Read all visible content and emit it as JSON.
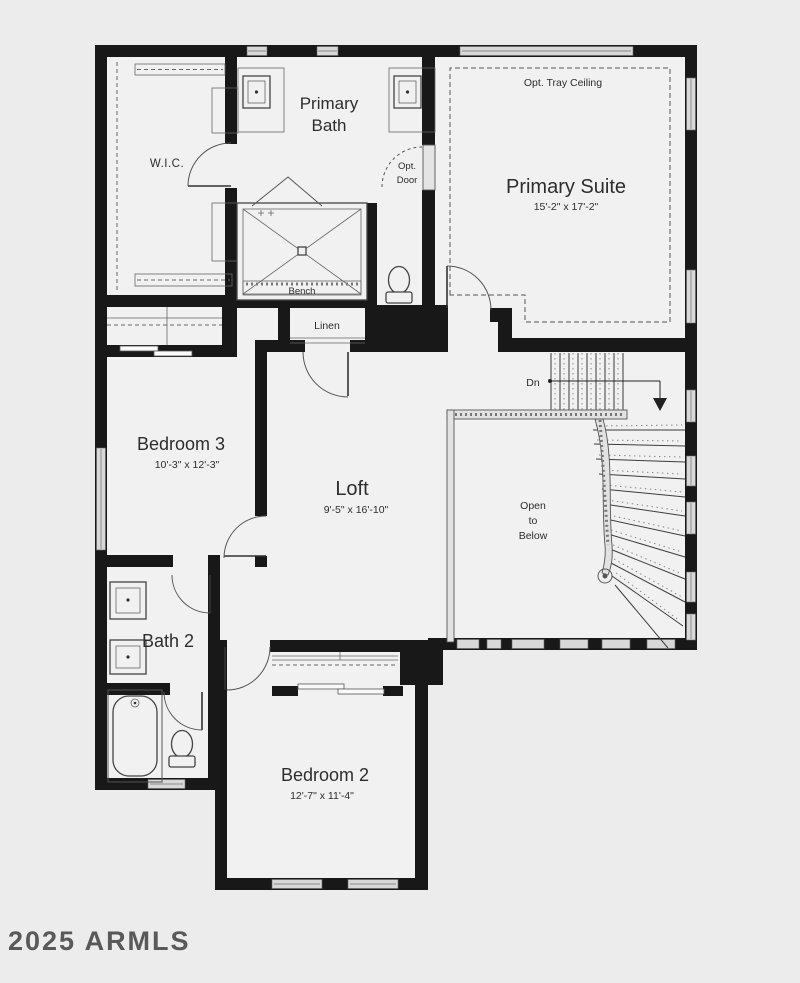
{
  "colors": {
    "background": "#ececec",
    "floor": "#f1f1f1",
    "wall": "#181818",
    "line": "#555555",
    "window_fill": "#d8d8d8",
    "text": "#2d2d2d",
    "watermark_text": "#4a4a4a"
  },
  "watermark": "2025 ARMLS",
  "rooms": {
    "primary_bath": {
      "line1": "Primary",
      "line2": "Bath"
    },
    "wic": {
      "name": "W.I.C."
    },
    "primary_suite": {
      "name": "Primary Suite",
      "dims": "15'-2\" x 17'-2\"",
      "tray": "Opt. Tray Ceiling"
    },
    "bedroom3": {
      "name": "Bedroom 3",
      "dims": "10'-3\" x 12'-3\""
    },
    "loft": {
      "name": "Loft",
      "dims": "9'-5\" x 16'-10\""
    },
    "bath2": {
      "name": "Bath 2"
    },
    "bedroom2": {
      "name": "Bedroom 2",
      "dims": "12'-7\" x 11'-4\""
    },
    "open_to_below": {
      "line1": "Open",
      "line2": "to",
      "line3": "Below"
    }
  },
  "labels": {
    "bench": "Bench",
    "linen": "Linen",
    "down": "Dn",
    "opt_door_line1": "Opt.",
    "opt_door_line2": "Door"
  }
}
